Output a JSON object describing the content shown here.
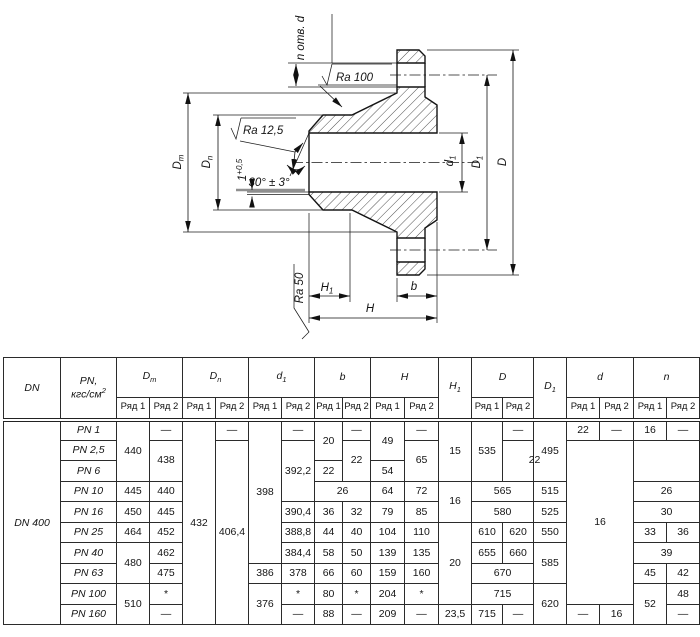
{
  "drawing": {
    "labels": {
      "n_holes": "n отв. d",
      "ra_100": "Ra 100",
      "ra_12_5": "Ra 12,5",
      "ra_50": "Ra 50",
      "bevel_angle": "30° ± 3°",
      "land": {
        "base": "1",
        "sup": "+0,5"
      },
      "dim_dm": {
        "base": "D",
        "sub": "m"
      },
      "dim_dn": {
        "base": "D",
        "sub": "n"
      },
      "dim_d1": {
        "base": "d",
        "sub": "1"
      },
      "dim_D1": {
        "base": "D",
        "sub": "1"
      },
      "dim_D": "D",
      "dim_H1": {
        "base": "H",
        "sub": "1"
      },
      "dim_H": "H",
      "dim_b": "b"
    }
  },
  "table": {
    "series": [
      "Ряд 1",
      "Ряд 2"
    ],
    "groups": [
      {
        "t": "DN"
      },
      {
        "t": "PN,\nкгс/см^2^"
      },
      {
        "t": "D~m~",
        "s": 1
      },
      {
        "t": "D~n~",
        "s": 1
      },
      {
        "t": "d~1~",
        "s": 1
      },
      {
        "t": "b",
        "s": 1
      },
      {
        "t": "H",
        "s": 1
      },
      {
        "t": "H~1~"
      },
      {
        "t": "D",
        "s": 1
      },
      {
        "t": "D~1~"
      },
      {
        "t": "d",
        "s": 1
      },
      {
        "t": "n",
        "s": 1
      }
    ],
    "rows": [
      [
        {
          "t": "DN 400",
          "r": 10,
          "k": "dn"
        },
        {
          "t": "PN 1",
          "k": "pn"
        },
        {
          "t": "440",
          "r": 3
        },
        {
          "t": "—"
        },
        {
          "t": "432",
          "r": 10
        },
        {
          "t": "—"
        },
        {
          "t": "398",
          "r": 7
        },
        {
          "t": "—"
        },
        {
          "t": "20",
          "r": 2
        },
        {
          "t": "—"
        },
        {
          "t": "49",
          "r": 2
        },
        {
          "t": "—"
        },
        {
          "t": "15",
          "r": 3
        },
        {
          "t": "535",
          "r": 3
        },
        {
          "t": "—"
        },
        {
          "t": "495",
          "r": 3
        },
        {
          "t": "22"
        },
        {
          "t": "—"
        },
        {
          "t": "16"
        },
        {
          "t": "—"
        }
      ],
      [
        {
          "t": "PN 2,5",
          "k": "pn"
        },
        {
          "t": "438",
          "r": 2
        },
        {
          "t": "406,4",
          "r": 9
        },
        {
          "t": "392,2",
          "r": 3
        },
        {
          "t": "22",
          "r": 2
        },
        {
          "t": "65",
          "r": 2
        },
        {
          "t": "22",
          "r": 2,
          "c": 2
        },
        {
          "t": "16",
          "r": 8,
          "c": 2
        }
      ],
      [
        {
          "t": "PN 6",
          "k": "pn"
        },
        {
          "t": "22"
        },
        {
          "t": "54"
        }
      ],
      [
        {
          "t": "PN 10",
          "k": "pn"
        },
        {
          "t": "445"
        },
        {
          "t": "440"
        },
        {
          "t": "26",
          "c": 2
        },
        {
          "t": "64"
        },
        {
          "t": "72"
        },
        {
          "t": "16",
          "r": 2
        },
        {
          "t": "565",
          "c": 2
        },
        {
          "t": "515"
        },
        {
          "t": "26",
          "c": 2
        }
      ],
      [
        {
          "t": "PN 16",
          "k": "pn"
        },
        {
          "t": "450"
        },
        {
          "t": "445"
        },
        {
          "t": "390,4"
        },
        {
          "t": "36"
        },
        {
          "t": "32"
        },
        {
          "t": "79"
        },
        {
          "t": "85"
        },
        {
          "t": "580",
          "c": 2
        },
        {
          "t": "525"
        },
        {
          "t": "30",
          "c": 2
        }
      ],
      [
        {
          "t": "PN 25",
          "k": "pn"
        },
        {
          "t": "464"
        },
        {
          "t": "452"
        },
        {
          "t": "388,8"
        },
        {
          "t": "44"
        },
        {
          "t": "40"
        },
        {
          "t": "104"
        },
        {
          "t": "110"
        },
        {
          "t": "20",
          "r": 4
        },
        {
          "t": "610"
        },
        {
          "t": "620"
        },
        {
          "t": "550"
        },
        {
          "t": "33"
        },
        {
          "t": "36"
        }
      ],
      [
        {
          "t": "PN 40",
          "k": "pn"
        },
        {
          "t": "480",
          "r": 2
        },
        {
          "t": "462"
        },
        {
          "t": "384,4"
        },
        {
          "t": "58"
        },
        {
          "t": "50"
        },
        {
          "t": "139"
        },
        {
          "t": "135"
        },
        {
          "t": "655"
        },
        {
          "t": "660"
        },
        {
          "t": "585",
          "r": 2
        },
        {
          "t": "39",
          "c": 2
        }
      ],
      [
        {
          "t": "PN 63",
          "k": "pn"
        },
        {
          "t": "475"
        },
        {
          "t": "386"
        },
        {
          "t": "378"
        },
        {
          "t": "66"
        },
        {
          "t": "60"
        },
        {
          "t": "159"
        },
        {
          "t": "160"
        },
        {
          "t": "670",
          "c": 2
        },
        {
          "t": "45"
        },
        {
          "t": "42"
        }
      ],
      [
        {
          "t": "PN 100",
          "k": "pn"
        },
        {
          "t": "510",
          "r": 2
        },
        {
          "t": "*"
        },
        {
          "t": "376",
          "r": 2
        },
        {
          "t": "*"
        },
        {
          "t": "80"
        },
        {
          "t": "*"
        },
        {
          "t": "204"
        },
        {
          "t": "*"
        },
        {
          "t": "715",
          "c": 2
        },
        {
          "t": "620",
          "r": 2
        },
        {
          "t": "52",
          "r": 2
        },
        {
          "t": "48"
        }
      ],
      [
        {
          "t": "PN 160",
          "k": "pn"
        },
        {
          "t": "—"
        },
        {
          "t": "—"
        },
        {
          "t": "88"
        },
        {
          "t": "—"
        },
        {
          "t": "209"
        },
        {
          "t": "—"
        },
        {
          "t": "23,5"
        },
        {
          "t": "715"
        },
        {
          "t": "—"
        },
        {
          "t": "—"
        },
        {
          "t": "16"
        },
        {
          "t": "—"
        }
      ]
    ]
  }
}
